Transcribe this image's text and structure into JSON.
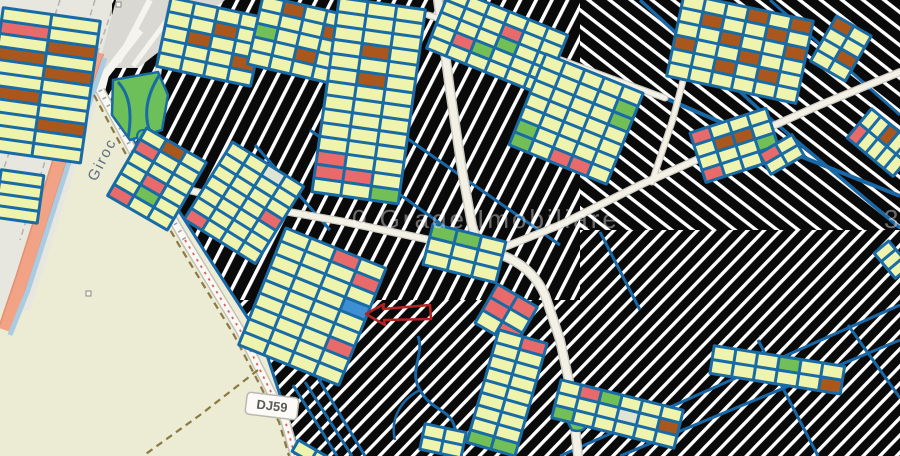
{
  "map": {
    "labels": {
      "area": "Giroc",
      "road_badge": "DJ59"
    },
    "watermark": {
      "text": "0 Grade Imobiliare",
      "partial_right": "3"
    },
    "annotation": {
      "type": "arrow-pointing-to-parcel",
      "color": "#b52222"
    },
    "palette": {
      "background_land": "#ecebd3",
      "unzoned_black": "#0a0a0a",
      "hatch_white": "#ffffff",
      "parcel_border": "#186ba4",
      "parcel_fill": "#eef3ae",
      "red": "#e96a6a",
      "green": "#72bf57",
      "brown": "#a9571c",
      "blue": "#3f8fd4",
      "cream": "#dfe5d2",
      "highway_orange": "#f2a285",
      "canal_blue": "#a9cce3",
      "street_fill": "#f3f1e6",
      "boundary_olive": "#8a7a42",
      "road_red_dash": "#d96060"
    },
    "blocks": [
      {
        "x": 2,
        "y": 6,
        "rot": 8,
        "cols": 2,
        "rows": 11,
        "cw": 46,
        "ch": 10,
        "accents": {
          "1-0": "red",
          "2-1": "brown",
          "3-0": "brown",
          "4-1": "brown",
          "6-0": "brown",
          "8-1": "brown"
        }
      },
      {
        "x": 0,
        "y": 168,
        "rot": 8,
        "cols": 1,
        "rows": 4,
        "cw": 40,
        "ch": 9,
        "accents": {}
      },
      {
        "x": 170,
        "y": -4,
        "rot": 12,
        "cols": 4,
        "rows": 5,
        "cw": 21,
        "ch": 11,
        "accents": {
          "1-2": "brown",
          "2-1": "brown",
          "3-3": "brown"
        }
      },
      {
        "x": 262,
        "y": -6,
        "rot": 13,
        "cols": 4,
        "rows": 5,
        "cw": 19,
        "ch": 11,
        "accents": {
          "0-1": "brown",
          "1-3": "brown",
          "2-0": "green",
          "3-2": "brown"
        }
      },
      {
        "x": 338,
        "y": -4,
        "rot": 8,
        "cols": 3,
        "rows": 14,
        "cw": 26,
        "ch": 11,
        "accents": {
          "3-1": "brown",
          "5-1": "brown",
          "11-0": "red",
          "12-0": "red",
          "12-1": "red",
          "13-2": "green"
        }
      },
      {
        "x": 450,
        "y": -14,
        "rot": 22,
        "cols": 6,
        "rows": 5,
        "cw": 18,
        "ch": 10,
        "accents": {
          "1-3": "red",
          "2-3": "green",
          "3-1": "red",
          "3-2": "green"
        }
      },
      {
        "x": 545,
        "y": 52,
        "rot": 22,
        "cols": 5,
        "rows": 7,
        "cw": 18,
        "ch": 11,
        "accents": {
          "1-4": "green",
          "2-4": "green",
          "5-0": "green",
          "6-0": "green",
          "6-2": "red",
          "6-3": "red"
        }
      },
      {
        "x": 683,
        "y": -8,
        "rot": 12,
        "cols": 6,
        "rows": 6,
        "cw": 19,
        "ch": 11,
        "accents": {
          "0-3": "brown",
          "0-5": "brown",
          "1-1": "brown",
          "1-4": "brown",
          "2-2": "brown",
          "2-5": "brown",
          "3-0": "brown",
          "3-3": "brown",
          "4-2": "brown",
          "4-4": "brown"
        }
      },
      {
        "x": 836,
        "y": 14,
        "rot": 30,
        "cols": 2,
        "rows": 4,
        "cw": 17,
        "ch": 10,
        "accents": {
          "0-0": "brown",
          "2-1": "brown"
        }
      },
      {
        "x": 688,
        "y": 132,
        "rot": -18,
        "cols": 4,
        "rows": 4,
        "cw": 17,
        "ch": 10,
        "accents": {
          "0-0": "red",
          "1-1": "brown",
          "1-2": "brown",
          "2-3": "green",
          "3-0": "red"
        }
      },
      {
        "x": 146,
        "y": 126,
        "rot": 30,
        "cols": 3,
        "rows": 6,
        "cw": 20,
        "ch": 10,
        "accents": {
          "0-1": "brown",
          "1-0": "red",
          "3-1": "red",
          "4-1": "green",
          "5-0": "red"
        }
      },
      {
        "x": 232,
        "y": 140,
        "rot": 32,
        "cols": 4,
        "rows": 7,
        "cw": 18,
        "ch": 10,
        "accents": {
          "0-2": "cream",
          "3-3": "red",
          "6-0": "red"
        }
      },
      {
        "x": 285,
        "y": 226,
        "rot": 22,
        "cols": 4,
        "rows": 9,
        "cw": 24,
        "ch": 11,
        "accents": {
          "0-2": "red",
          "1-3": "red",
          "3-3": "blue",
          "6-3": "red"
        }
      },
      {
        "x": 432,
        "y": 222,
        "rot": 14,
        "cols": 3,
        "rows": 3,
        "cw": 22,
        "ch": 11,
        "accents": {
          "0-0": "green",
          "0-1": "green"
        }
      },
      {
        "x": 497,
        "y": 282,
        "rot": 30,
        "cols": 2,
        "rows": 3,
        "cw": 20,
        "ch": 12,
        "accents": {
          "0-0": "red",
          "0-1": "red",
          "1-0": "red",
          "2-1": "red"
        }
      },
      {
        "x": 498,
        "y": 328,
        "rot": 16,
        "cols": 2,
        "rows": 9,
        "cw": 22,
        "ch": 10,
        "accents": {
          "0-1": "red",
          "8-0": "green",
          "8-1": "green"
        }
      },
      {
        "x": 560,
        "y": 378,
        "rot": 14,
        "cols": 6,
        "rows": 3,
        "cw": 18,
        "ch": 10,
        "accents": {
          "0-1": "red",
          "0-2": "green",
          "1-3": "cream",
          "1-5": "brown",
          "2-0": "green"
        }
      },
      {
        "x": 713,
        "y": 344,
        "rot": 9,
        "cols": 6,
        "rows": 2,
        "cw": 19,
        "ch": 11,
        "accents": {
          "0-3": "green",
          "1-5": "brown"
        }
      },
      {
        "x": 845,
        "y": 138,
        "rot": -50,
        "cols": 2,
        "rows": 5,
        "cw": 16,
        "ch": 9,
        "accents": {
          "0-0": "red",
          "2-1": "brown"
        }
      },
      {
        "x": 757,
        "y": 153,
        "rot": -30,
        "cols": 2,
        "rows": 2,
        "cw": 16,
        "ch": 9,
        "accents": {
          "0-0": "red"
        }
      },
      {
        "x": 872,
        "y": 253,
        "rot": -40,
        "cols": 1,
        "rows": 3,
        "cw": 16,
        "ch": 8,
        "accents": {}
      },
      {
        "x": 424,
        "y": 422,
        "rot": 12,
        "cols": 2,
        "rows": 2,
        "cw": 18,
        "ch": 10,
        "accents": {}
      },
      {
        "x": 298,
        "y": 438,
        "rot": 30,
        "cols": 2,
        "rows": 1,
        "cw": 18,
        "ch": 10,
        "accents": {}
      }
    ]
  }
}
